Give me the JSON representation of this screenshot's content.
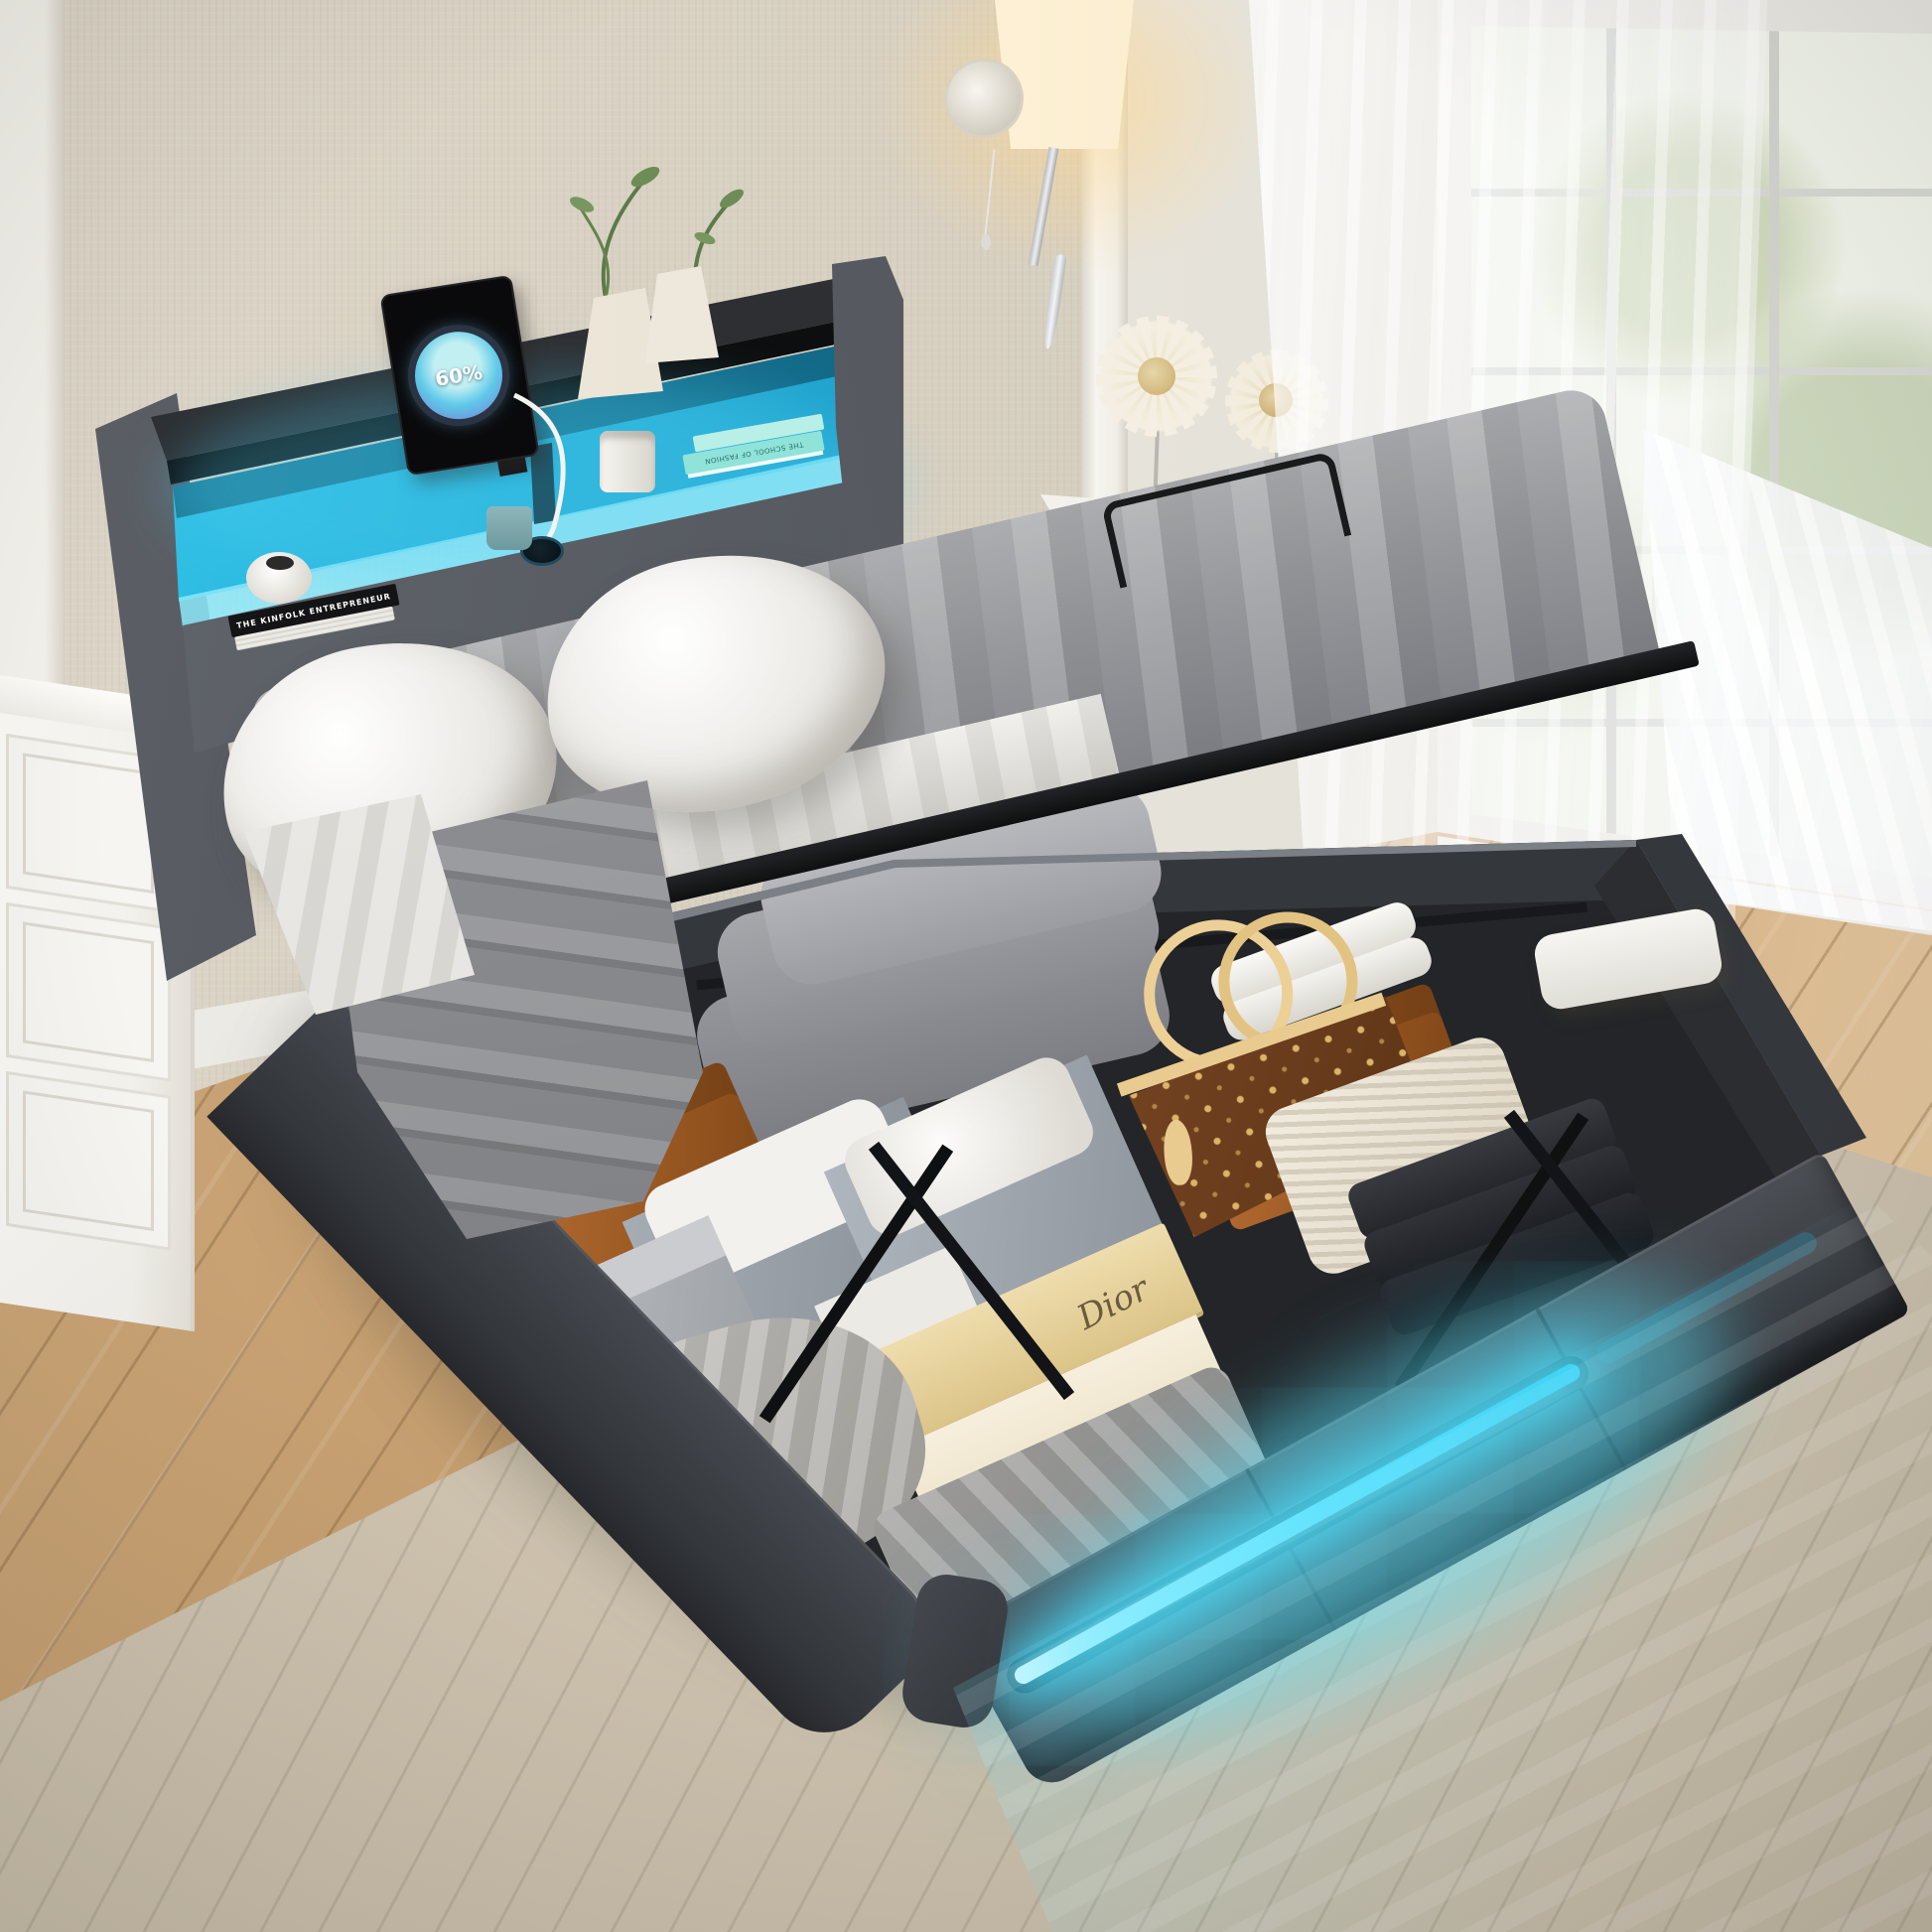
{
  "tablet": {
    "battery_label": "60%"
  },
  "shelf_items": {
    "black_book_spine": "THE KINFOLK ENTREPRENEUR",
    "teal_book_spine": "THE SCHOOL OF FASHION"
  },
  "storage_items": {
    "dior_box_label": "Dior"
  },
  "colors": {
    "led_cyan": "#3cd7fb",
    "led_glow": "#7deaff",
    "headboard_fabric": "#5a5e64",
    "base_fabric": "#44474d",
    "shelf_black": "#17181a",
    "wall_beige": "#d8d1c2",
    "wood_floor": "#c29a68",
    "rug_beige": "#cfc5b1",
    "mattress_gray": "#949599",
    "pillow_white": "#f2f0ee",
    "trunk_leather": "#b06a30",
    "dior_beige": "#e9dcae",
    "handbag_brown": "#6e3f1c",
    "handbag_tan": "#e9cb8f",
    "lamp_warm": "#ffd78f"
  }
}
